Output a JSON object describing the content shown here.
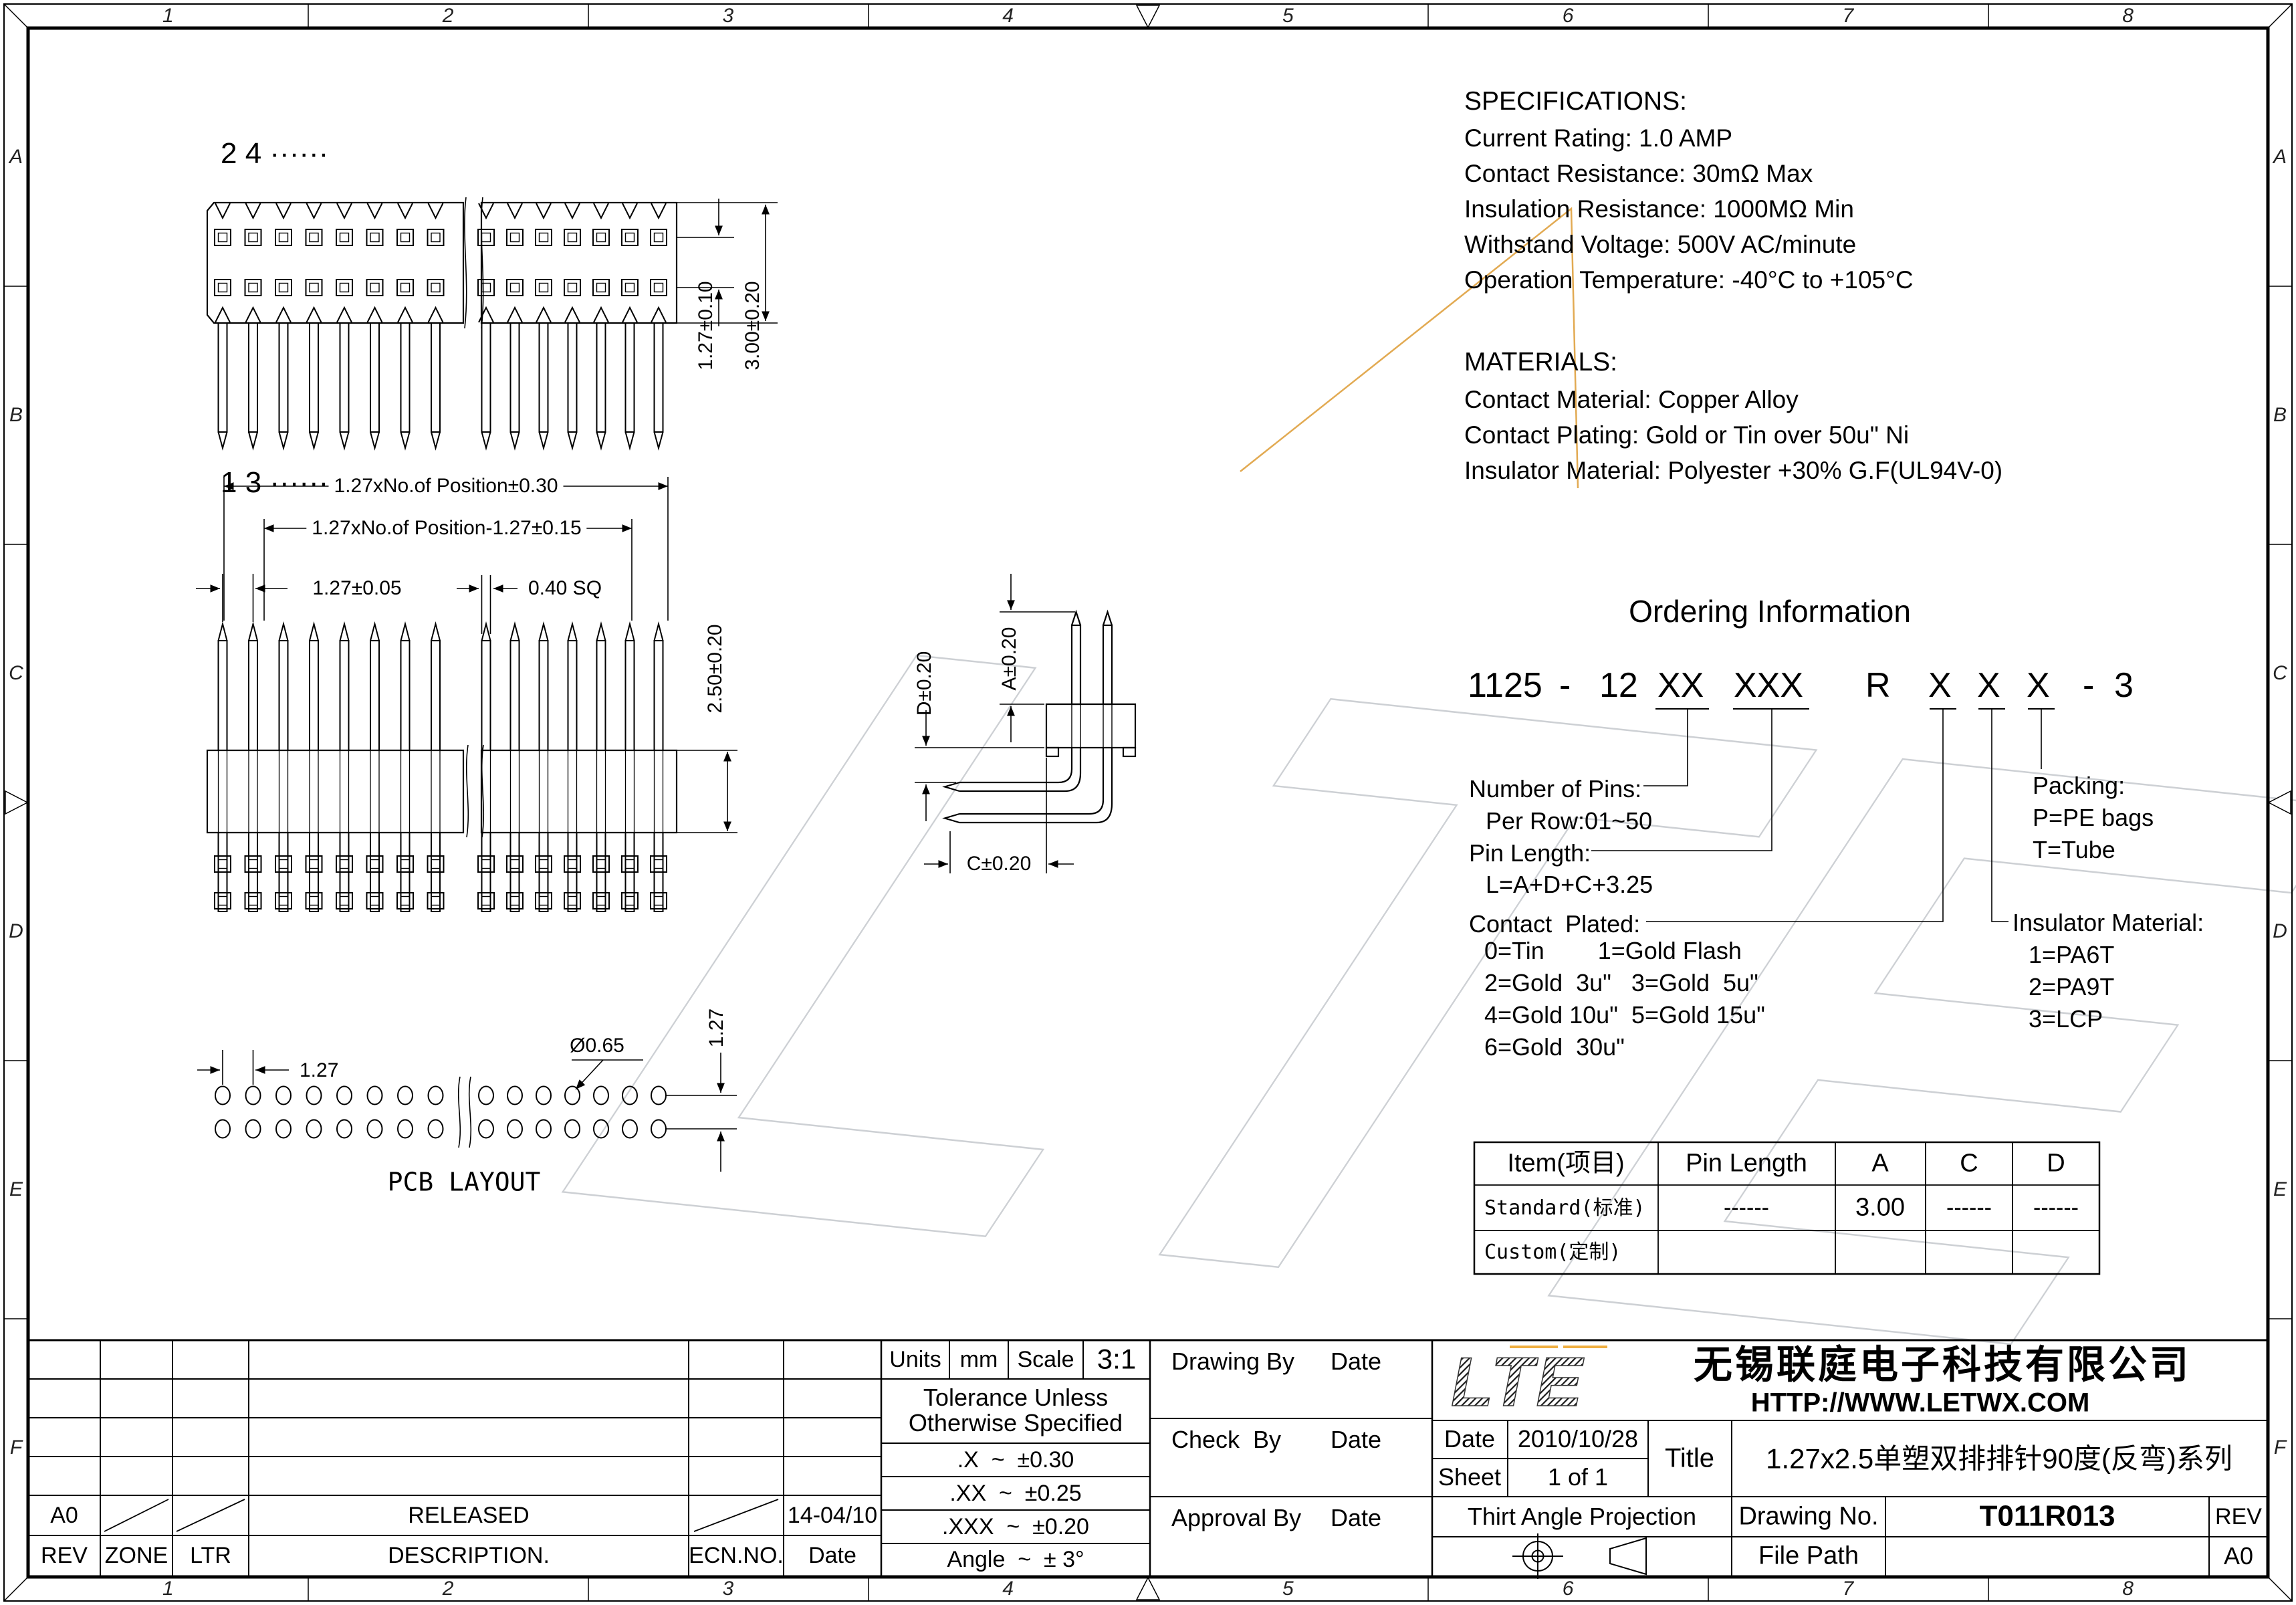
{
  "frame": {
    "zone_cols": [
      "1",
      "2",
      "3",
      "4",
      "5",
      "6",
      "7",
      "8"
    ],
    "zone_rows": [
      "A",
      "B",
      "C",
      "D",
      "E",
      "F"
    ]
  },
  "specifications": {
    "title": "SPECIFICATIONS:",
    "lines": [
      "Current Rating: 1.0 AMP",
      "Contact Resistance: 30mΩ Max",
      "Insulation Resistance: 1000MΩ Min",
      "Withstand Voltage: 500V AC/minute",
      "Operation Temperature: -40°C to +105°C"
    ]
  },
  "materials": {
    "title": "MATERIALS:",
    "lines": [
      "Contact Material: Copper Alloy",
      "Contact Plating: Gold or Tin over 50u\" Ni",
      "Insulator Material: Polyester +30% G.F(UL94V-0)"
    ]
  },
  "ordering": {
    "title": "Ordering Information",
    "part_number": "1125 - 12 XX XXX R X X X - 3",
    "part_groups": [
      "1125",
      "-",
      "12",
      "XX",
      "XXX",
      "R",
      "X",
      "X",
      "X",
      "-",
      "3"
    ],
    "number_of_pins_label": "Number of Pins:",
    "number_of_pins_value": "Per Row:01~50",
    "pin_length_label": "Pin Length:",
    "pin_length_value": "L=A+D+C+3.25",
    "contact_plated_label": "Contact  Plated:",
    "contact_plated_lines": [
      "0=Tin        1=Gold Flash",
      "2=Gold  3u\"   3=Gold  5u\"",
      "4=Gold 10u\"  5=Gold 15u\"",
      "6=Gold  30u\""
    ],
    "packing_label": "Packing:",
    "packing_options": [
      "P=PE bags",
      "T=Tube"
    ],
    "insulator_label": "Insulator Material:",
    "insulator_options": [
      "1=PA6T",
      "2=PA9T",
      "3=LCP"
    ]
  },
  "dim_table": {
    "headers": [
      "Item(项目)",
      "Pin Length",
      "A",
      "C",
      "D"
    ],
    "standard_label": "Standard(标准)",
    "standard_values": [
      "------",
      "3.00",
      "------",
      "------"
    ],
    "custom_label": "Custom(定制)"
  },
  "views": {
    "pins_per_row_visible": 15,
    "top_view": {
      "row_even_label": "2 4 ······",
      "row_odd_label": "1 3 ······",
      "dim_row_pitch": "1.27±0.10",
      "dim_height": "3.00±0.20"
    },
    "front_view": {
      "dim_overall": "1.27xNo.of Position±0.30",
      "dim_inner": "1.27xNo.of Position-1.27±0.15",
      "dim_pitch": "1.27±0.05",
      "dim_pin": "0.40 SQ",
      "dim_body": "2.50±0.20"
    },
    "side_view": {
      "dim_a": "A±0.20",
      "dim_d": "D±0.20",
      "dim_c": "C±0.20"
    },
    "pcb": {
      "label": "PCB LAYOUT",
      "dim_pitch": "1.27",
      "dim_hole": "Ø0.65",
      "dim_row_pitch": "1.27"
    }
  },
  "revision": {
    "headers": [
      "REV",
      "ZONE",
      "LTR",
      "DESCRIPTION.",
      "ECN.NO.",
      "Date"
    ],
    "rev": "A0",
    "description": "RELEASED",
    "date": "14-04/10"
  },
  "tolerance": {
    "units_label": "Units",
    "units_value": "mm",
    "scale_label": "Scale",
    "scale_value": "3:1",
    "title_line1": "Tolerance Unless",
    "title_line2": "Otherwise Specified",
    "rows": [
      ".X  ~  ±0.30",
      ".XX  ~  ±0.25",
      ".XXX  ~  ±0.20",
      "Angle  ~  ± 3°"
    ]
  },
  "signoff": {
    "drawing_by": "Drawing By",
    "check_by": "Check  By",
    "approval_by": "Approval By",
    "date": "Date"
  },
  "title_block": {
    "logo_text": "LTE",
    "company": "无锡联庭电子科技有限公司",
    "website": "HTTP://WWW.LETWX.COM",
    "date_label": "Date",
    "date_value": "2010/10/28",
    "sheet_label": "Sheet",
    "sheet_value": "1 of 1",
    "title_label": "Title",
    "title_value": "1.27x2.5单塑双排排针90度(反弯)系列",
    "projection_label": "Thirt Angle Projection",
    "drawing_no_label": "Drawing No.",
    "drawing_no_value": "T011R013",
    "rev_label": "REV",
    "file_path_label": "File Path",
    "size": "A0"
  }
}
